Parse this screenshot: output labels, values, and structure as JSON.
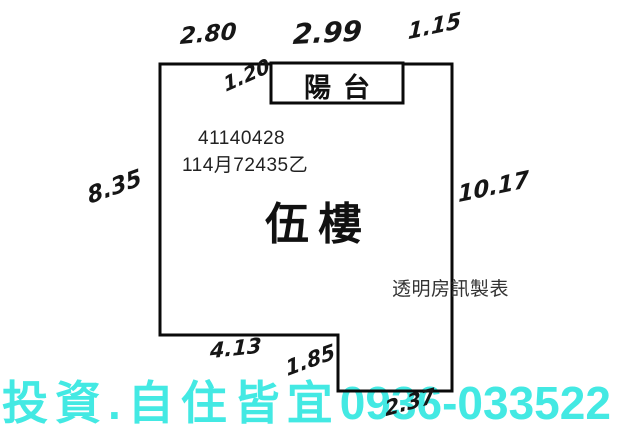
{
  "floor_plan": {
    "unit_number": "41140428",
    "registration": "114月72435乙",
    "floor_label": "伍樓",
    "balcony_label": "陽台",
    "maker_credit": "透明房訊製表",
    "dimensions": {
      "top_left": "2.80",
      "top_middle": "2.99",
      "top_right": "1.15",
      "balcony_depth": "1.20",
      "left_side": "8.35",
      "right_side": "10.17",
      "bottom_left": "4.13",
      "step_height": "1.85",
      "bottom_right": "2.37"
    }
  },
  "watermark": {
    "text_cjk": "投資.自住皆宜",
    "phone": "0936-033522",
    "color": "#43E9E3"
  },
  "colors": {
    "ink": "#111111",
    "background": "#ffffff"
  }
}
